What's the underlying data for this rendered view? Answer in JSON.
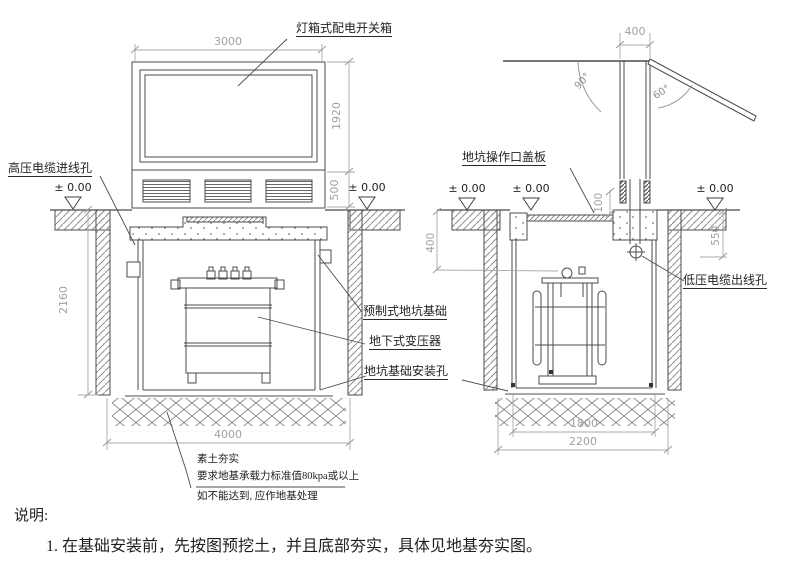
{
  "drawing": {
    "labels": {
      "switch_box": "灯箱式配电开关箱",
      "hv_cable_hole": "高压电缆进线孔",
      "pit_cover": "地坑操作口盖板",
      "lv_cable_hole": "低压电缆出线孔",
      "precast_pit_foundation": "预制式地坑基础",
      "underground_transformer": "地下式变压器",
      "pit_mounting_hole": "地坑基础安装孔"
    },
    "levels": {
      "ground": "± 0.00"
    },
    "front_view": {
      "width": "3000",
      "cabinet_height": "1920",
      "base_height": "500",
      "pit_depth": "2160",
      "excavation_width": "4000"
    },
    "side_view": {
      "pole_width": "400",
      "angle_closed": "90°",
      "angle_open": "60°",
      "cover_step": "100",
      "hole_depth_left": "400",
      "hole_depth_right": "550",
      "pit_width": "1800",
      "excavation_width": "2200"
    },
    "foundation_notes": [
      "素土夯实",
      "要求地基承载力标准值80kpa或以上",
      "如不能达到, 应作地基处理"
    ],
    "notes": {
      "heading": "说明:",
      "item1": "1. 在基础安装前，先按图预挖土，并且底部夯实，具体见地基夯实图。"
    },
    "colors": {
      "line": "#4b4b4b",
      "dim": "#a3a3a3",
      "background": "#ffffff"
    }
  }
}
